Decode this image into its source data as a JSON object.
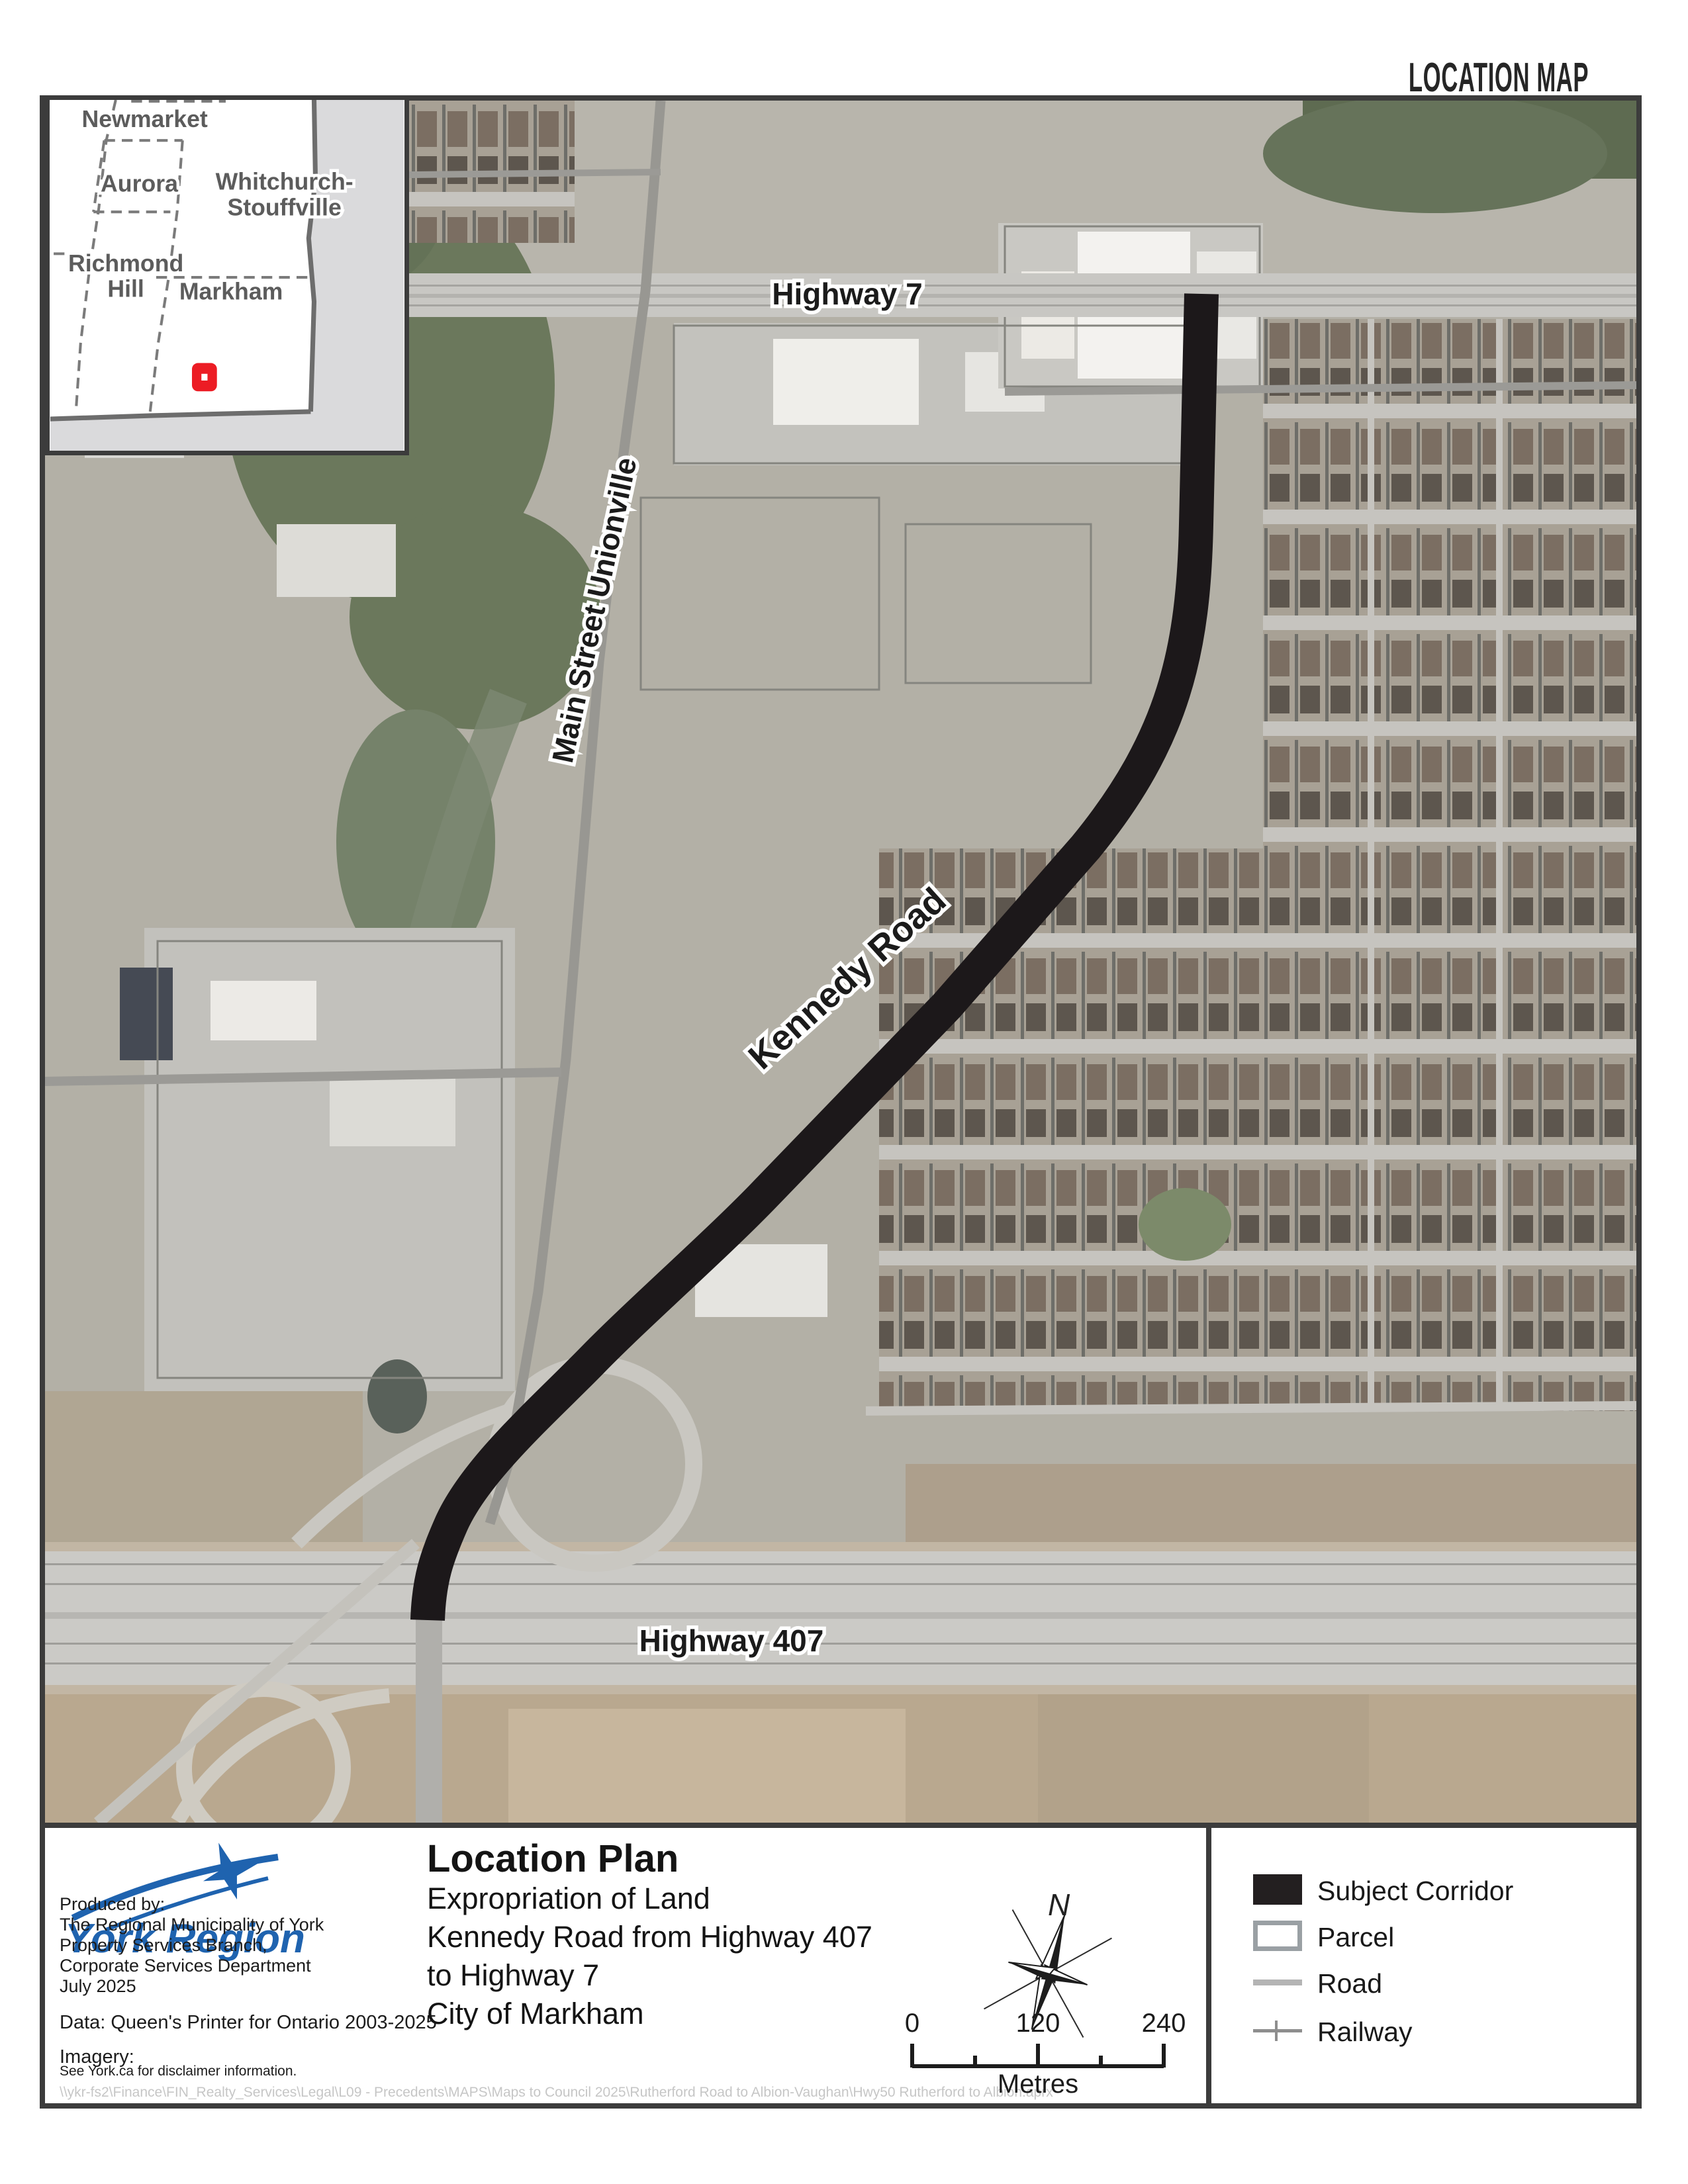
{
  "page": {
    "title": "LOCATION MAP"
  },
  "inset": {
    "labels": {
      "newmarket": "Newmarket",
      "aurora": "Aurora",
      "whitchurch_line1": "Whitchurch-",
      "whitchurch_line2": "Stouffville",
      "richmond_line1": "Richmond",
      "richmond_line2": "Hill",
      "markham": "Markham"
    },
    "marker_color": "#ec1c24"
  },
  "map": {
    "labels": {
      "highway7": "Highway 7",
      "main_street": "Main Street Unionville",
      "kennedy": "Kennedy Road",
      "highway407": "Highway 407"
    },
    "corridor_color": "#1c181a"
  },
  "title_block": {
    "title": "Location Plan",
    "lines": [
      "Expropriation of Land",
      "Kennedy Road from Highway 407",
      "to Highway 7",
      "City of Markham"
    ]
  },
  "credits": {
    "logo_text": "York Region",
    "logo_color": "#1f63af",
    "produced_by": [
      "Produced by:",
      "The Regional Municipality of York",
      "Property Services Branch,",
      "Corporate Services Department",
      "July 2025"
    ],
    "data_line": "Data: Queen's Printer for Ontario 2003-2025",
    "imagery_label": "Imagery:",
    "imagery_note": "See York.ca for disclaimer information.",
    "file_path": "\\\\ykr-fs2\\Finance\\FIN_Realty_Services\\Legal\\L09 - Precedents\\MAPS\\Maps to Council 2025\\Rutherford Road to Albion-Vaughan\\Hwy50 Rutherford to Albion.aprx"
  },
  "north_arrow": {
    "label": "N"
  },
  "scale_bar": {
    "ticks": [
      "0",
      "120",
      "240"
    ],
    "unit": "Metres"
  },
  "legend": {
    "items": [
      {
        "label": "Subject Corridor",
        "type": "fill",
        "color": "#231f20"
      },
      {
        "label": "Parcel",
        "type": "outline",
        "color": "#9aa0a4"
      },
      {
        "label": "Road",
        "type": "line",
        "color": "#b4b4b4"
      },
      {
        "label": "Railway",
        "type": "railline",
        "color": "#8e8e8e"
      }
    ]
  }
}
